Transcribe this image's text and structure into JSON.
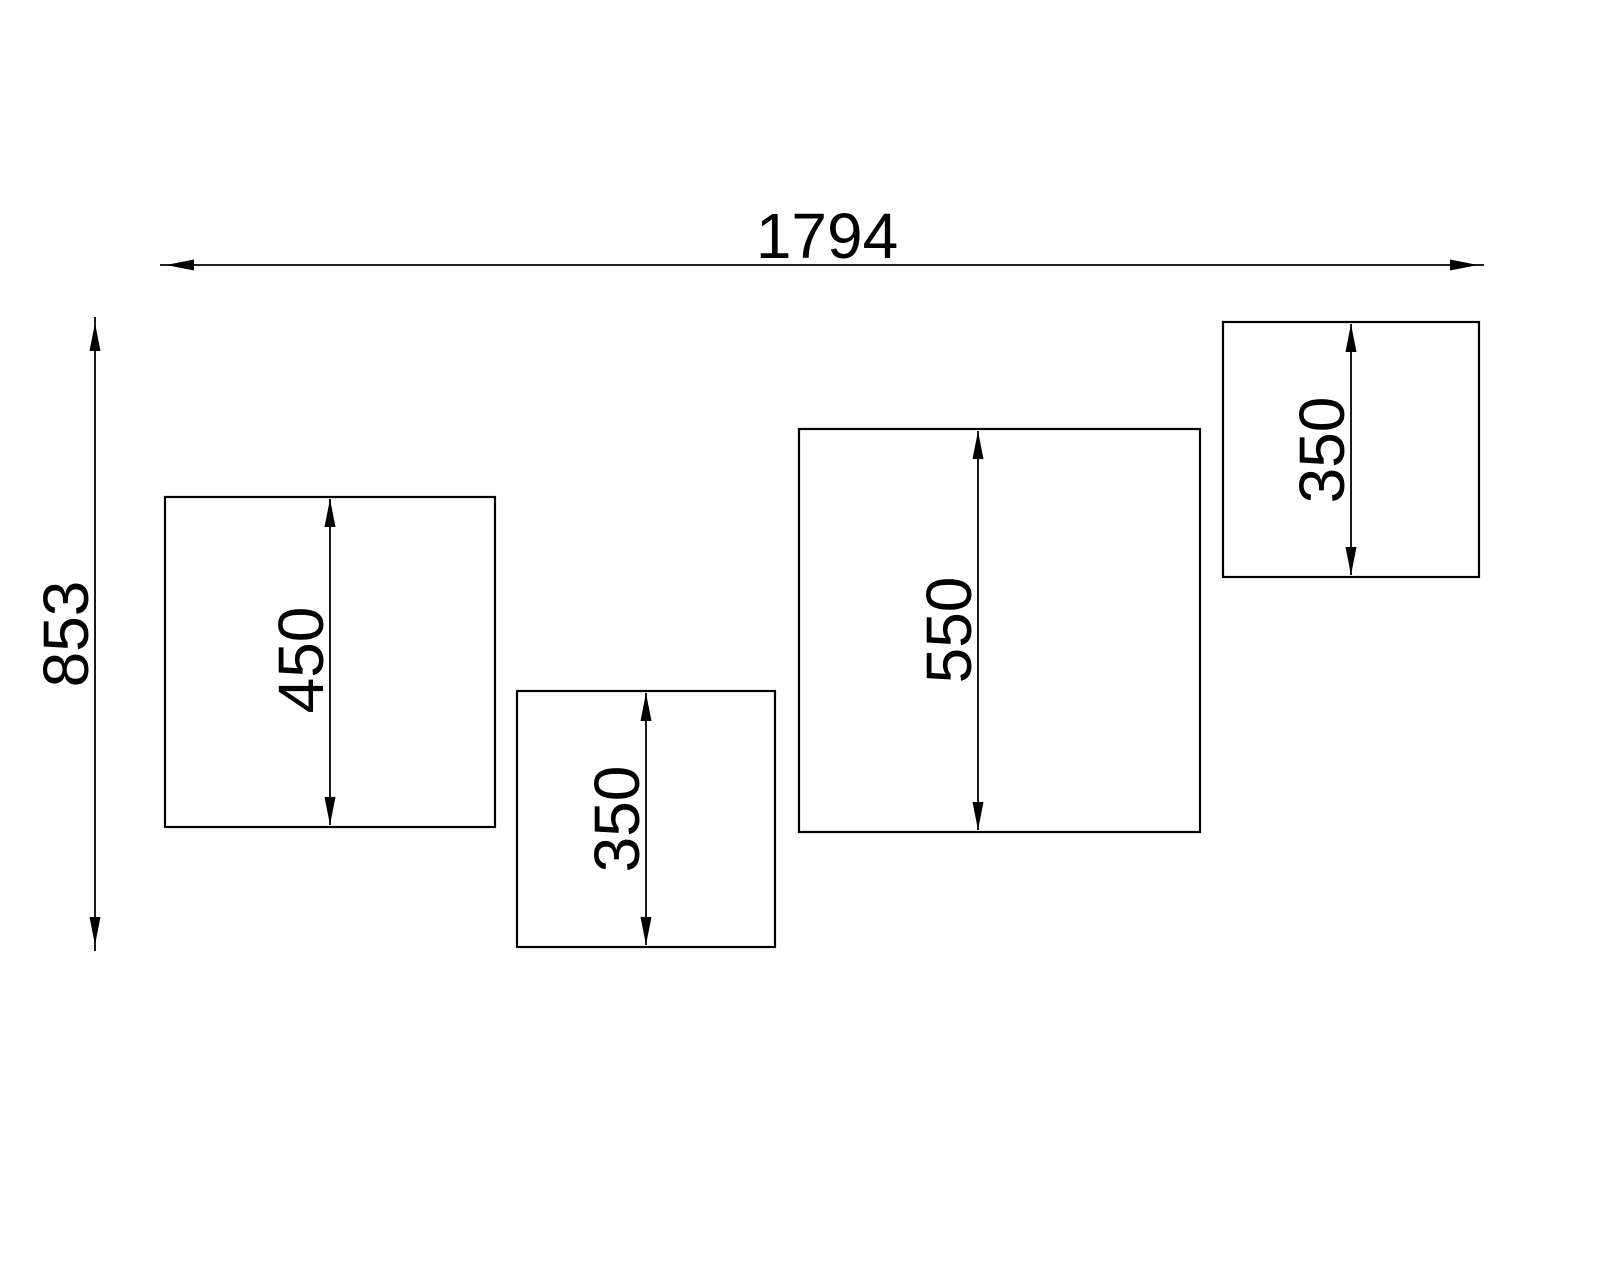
{
  "drawing": {
    "type": "technical-dimension-drawing",
    "background_color": "#ffffff",
    "line_color": "#000000",
    "overall": {
      "width_label": "1794",
      "height_label": "853"
    },
    "panels": [
      {
        "id": "panel-1",
        "height_label": "450"
      },
      {
        "id": "panel-2",
        "height_label": "350"
      },
      {
        "id": "panel-3",
        "height_label": "550"
      },
      {
        "id": "panel-4",
        "height_label": "350"
      }
    ]
  }
}
